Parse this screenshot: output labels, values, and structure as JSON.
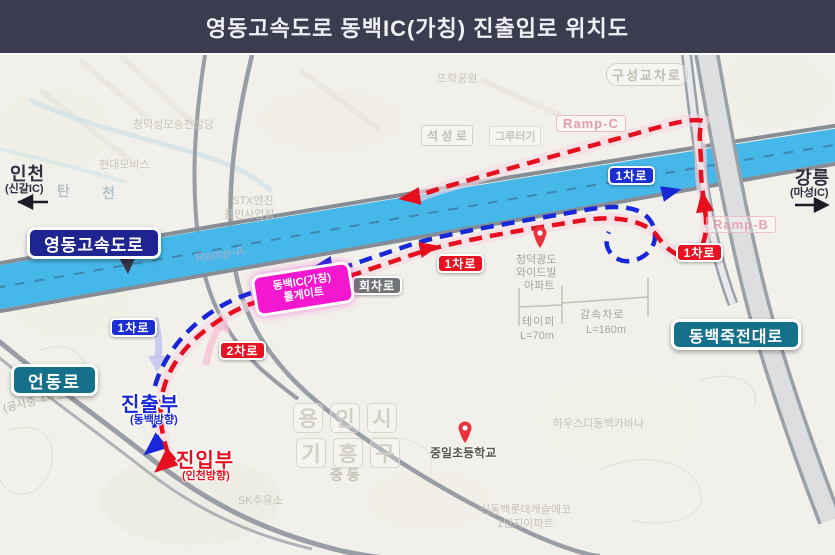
{
  "header": {
    "title": "영동고속도로 동백IC(가칭) 진출입로 위치도"
  },
  "directions": {
    "west": {
      "city": "인천",
      "ic": "(신갈IC)"
    },
    "east": {
      "city": "강릉",
      "ic": "(마성IC)"
    }
  },
  "road_labels": {
    "expressway": "영동고속도로",
    "eondong_ro": "언동로",
    "dongbaek_jukjeon_daero": "동백죽전대로"
  },
  "badges": {
    "lane1": "1차로",
    "lane2": "2차로",
    "turnaround": "회차로"
  },
  "tollgate": {
    "line1": "동백IC(가칭)",
    "line2": "톨게이트"
  },
  "points": {
    "exit": {
      "label": "진출부",
      "sub": "(동백방향)"
    },
    "entry": {
      "label": "진입부",
      "sub": "(인천방향)"
    }
  },
  "ramps": {
    "a": "Ramp-A",
    "b": "Ramp-B",
    "c": "Ramp-C"
  },
  "measurements": {
    "taper": {
      "label": "테이퍼",
      "value": "L=70m"
    },
    "decel": {
      "label": "감속차로",
      "value": "L=160m"
    }
  },
  "map_labels": {
    "ddeurak_park": "뜨락공원",
    "guseong_junction": "구성교차로",
    "seokseong_ro": "석 성 로",
    "gruteogi": "그루터기",
    "cathedral": "청덕성모승천성당",
    "hyundai_mobis": "현대모비스",
    "tan": "탄",
    "cheon": "천",
    "stx_line1": "STX엔진",
    "stx_line2": "용인사업장",
    "apt_line1": "청덕광도",
    "apt_line2": "와이드빌",
    "apt_line3": "아파트",
    "yongin_1": "용",
    "yongin_2": "인",
    "yongin_3": "시",
    "giheung_1": "기",
    "giheung_2": "흥",
    "giheung_3": "구",
    "jungdong": "중  동",
    "school": "중일초등학교",
    "cabana": "하우스디동백카바나",
    "lotte_line1": "신동백롯데캐슬에코",
    "lotte_line2": "1단지아파트",
    "sk_gas": "SK주유소",
    "construction": "(공사중-4차로 확장)"
  },
  "colors": {
    "header_bg": "#3c3c50",
    "map_bg": "#f2f0ea",
    "expressway_band": "#45b7e9",
    "route_red": "#e50f1e",
    "route_blue": "#1828d8",
    "tollgate_magenta": "#f318cf",
    "box_navy": "#1e2590",
    "box_teal": "#15718a"
  }
}
